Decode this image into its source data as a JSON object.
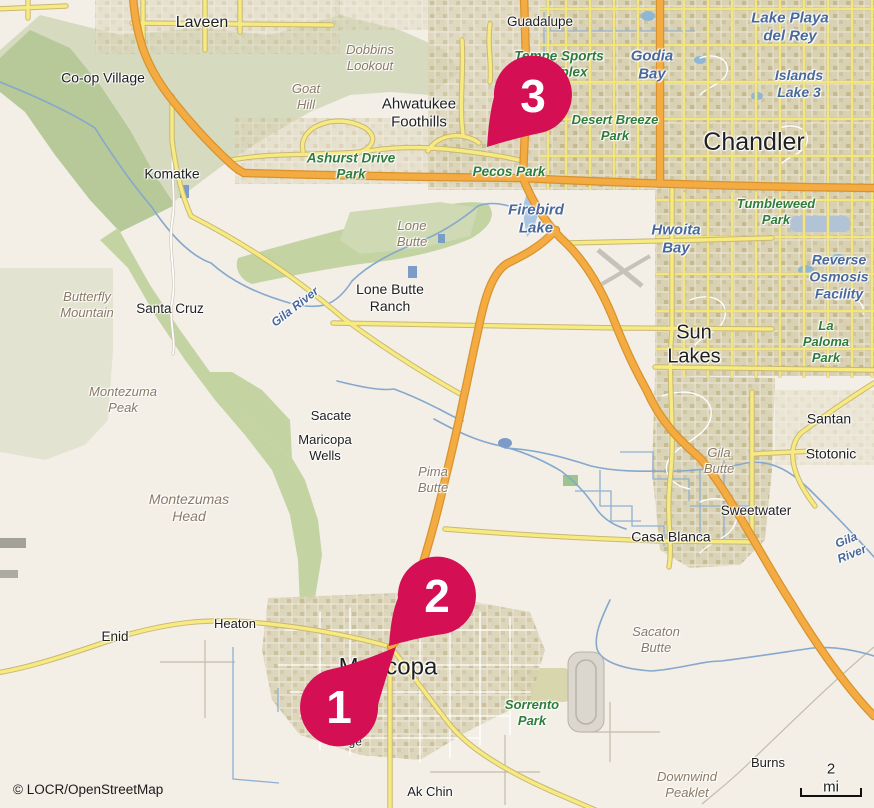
{
  "attribution": "© LOCR/OpenStreetMap",
  "scale": {
    "label": "2 mi"
  },
  "markers": [
    {
      "number": "1"
    },
    {
      "number": "2"
    },
    {
      "number": "3"
    }
  ],
  "colors": {
    "marker": "#d40f53",
    "road_major": "#f4ab42",
    "road_minor": "#f6ea80",
    "water": "#a9c5e2",
    "vegetation": "#c3d3a2",
    "park_label": "#2f7d3a",
    "water_label": "#49699b",
    "terrain_label": "#8b7a64"
  },
  "labels": {
    "laveen": "Laveen",
    "coop_village": "Co-op Village",
    "dobbins_lookout": "Dobbins\nLookout",
    "goat_hill": "Goat\nHill",
    "ahwatukee": "Ahwatukee\nFoothills",
    "guadalupe": "Guadalupe",
    "tempe_sports": "Tempe Sports\nComplex",
    "godia_bay": "Godia\nBay",
    "lake_playa": "Lake Playa\ndel Rey",
    "islands_lake": "Islands\nLake 3",
    "chandler": "Chandler",
    "desert_breeze": "Desert Breeze\nPark",
    "pecos_park": "Pecos Park",
    "ashurst": "Ashurst Drive\nPark",
    "komatke": "Komatke",
    "firebird": "Firebird\nLake",
    "lone_butte": "Lone\nButte",
    "lone_butte_ranch": "Lone Butte\nRanch",
    "tumbleweed": "Tumbleweed\nPark",
    "hwoita": "Hwoita\nBay",
    "reverse_osmosis": "Reverse\nOsmosis\nFacility",
    "sun_lakes": "Sun\nLakes",
    "la_paloma": "La Paloma\nPark",
    "butterfly": "Butterfly\nMountain",
    "santa_cruz": "Santa Cruz",
    "gila_river_w": "Gila River",
    "montezuma_peak": "Montezuma\nPeak",
    "montezumas_head": "Montezumas\nHead",
    "sacate": "Sacate",
    "maricopa_wells": "Maricopa\nWells",
    "pima_butte": "Pima\nButte",
    "santan": "Santan",
    "stotonic": "Stotonic",
    "gila_butte": "Gila\nButte",
    "sweetwater": "Sweetwater",
    "casa_blanca": "Casa Blanca",
    "gila_river_e": "Gila River",
    "enid": "Enid",
    "heaton": "Heaton",
    "maricopa": "Maricopa",
    "village": "Village",
    "sorrento": "Sorrento\nPark",
    "sacaton_butte": "Sacaton\nButte",
    "ak_chin": "Ak Chin",
    "burns": "Burns",
    "downwind": "Downwind\nPeaklet"
  }
}
